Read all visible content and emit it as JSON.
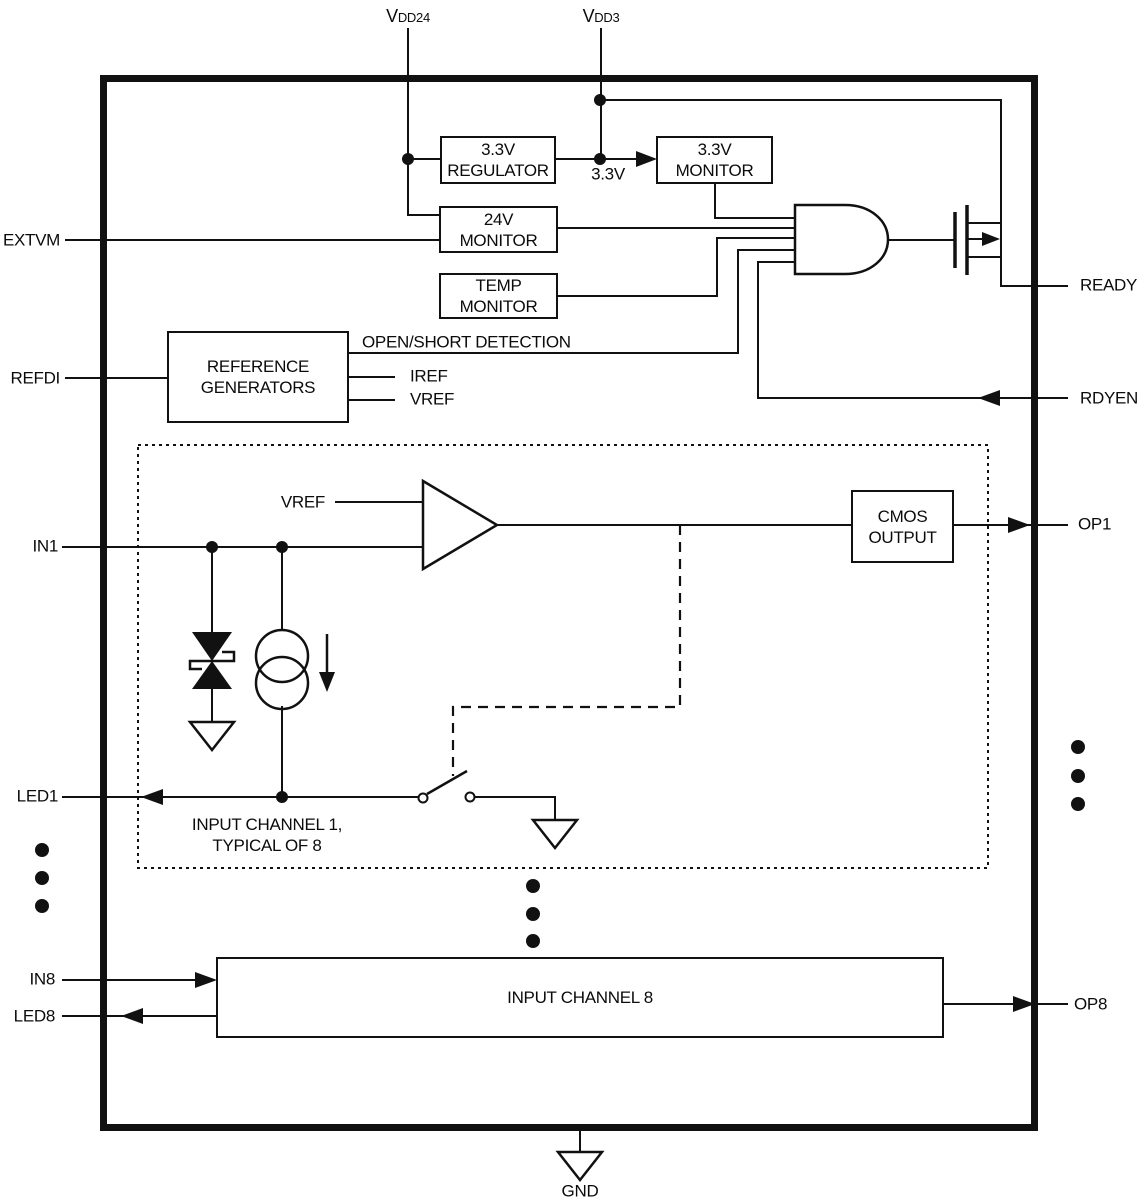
{
  "colors": {
    "line": "#111111",
    "background": "#ffffff",
    "text": "#0b0b0b"
  },
  "power_pins": {
    "vdd24_main": "V",
    "vdd24_sub": "DD24",
    "vdd3_main": "V",
    "vdd3_sub": "DD3"
  },
  "left_pins": {
    "extvm": "EXTVM",
    "refdi": "REFDI",
    "in1": "IN1",
    "led1": "LED1",
    "in8": "IN8",
    "led8": "LED8"
  },
  "right_pins": {
    "ready": "READY",
    "rdyen": "RDYEN",
    "op1": "OP1",
    "op8": "OP8"
  },
  "bottom_pins": {
    "gnd": "GND"
  },
  "blocks": {
    "regulator_33": {
      "line1": "3.3V",
      "line2": "REGULATOR"
    },
    "monitor_33": {
      "line1": "3.3V",
      "line2": "MONITOR"
    },
    "monitor_24": {
      "line1": "24V",
      "line2": "MONITOR"
    },
    "monitor_temp": {
      "line1": "TEMP",
      "line2": "MONITOR"
    },
    "reference_generators": {
      "line1": "REFERENCE",
      "line2": "GENERATORS"
    },
    "cmos_output": {
      "line1": "CMOS",
      "line2": "OUTPUT"
    },
    "input_channel_8": {
      "line1": "INPUT CHANNEL 8"
    }
  },
  "signals": {
    "open_short_detection": "OPEN/SHORT DETECTION",
    "iref": "IREF",
    "vref": "VREF",
    "vref_comparator": "VREF",
    "rail_33": "3.3V"
  },
  "notes": {
    "channel_note_line1": "INPUT CHANNEL 1,",
    "channel_note_line2": "TYPICAL OF 8"
  }
}
